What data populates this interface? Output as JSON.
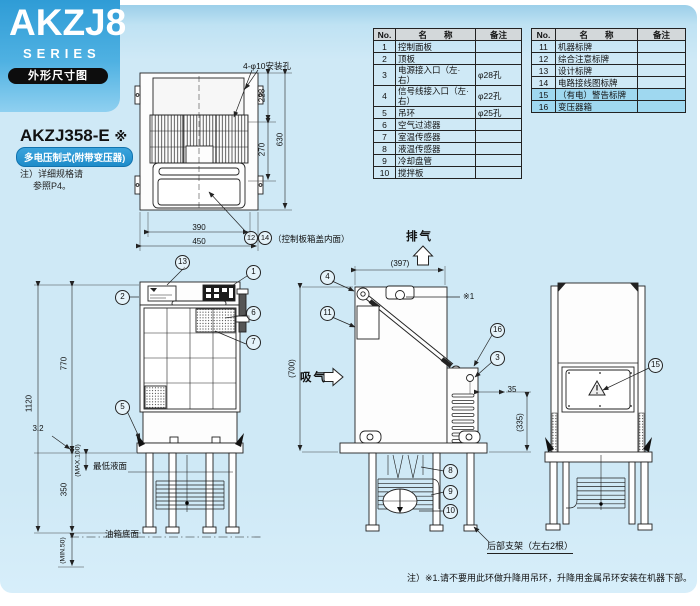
{
  "brand": {
    "series": "AKZJ8",
    "series_label": "SERIES",
    "page_tag": "外形尺寸图"
  },
  "model": {
    "name": "AKZJ358-E",
    "mark": "※",
    "badge": "多电压制式(附带变压器)",
    "note1": "注）详细规格请",
    "note2": "参照P4。"
  },
  "tables": {
    "headers": {
      "no": "No.",
      "name": "名　　称",
      "remark": "备注"
    },
    "left_rows": [
      {
        "no": "1",
        "name": "控制面板",
        "remark": ""
      },
      {
        "no": "2",
        "name": "顶板",
        "remark": ""
      },
      {
        "no": "3",
        "name": "电源接入口（左·右）",
        "remark": "φ28孔"
      },
      {
        "no": "4",
        "name": "信号线接入口（左·右）",
        "remark": "φ22孔"
      },
      {
        "no": "5",
        "name": "吊环",
        "remark": "φ25孔"
      },
      {
        "no": "6",
        "name": "空气过滤器",
        "remark": ""
      },
      {
        "no": "7",
        "name": "室温传感器",
        "remark": ""
      },
      {
        "no": "8",
        "name": "液温传感器",
        "remark": ""
      },
      {
        "no": "9",
        "name": "冷却盘管",
        "remark": ""
      },
      {
        "no": "10",
        "name": "搅拌板",
        "remark": ""
      }
    ],
    "right_rows": [
      {
        "no": "11",
        "name": "机器标牌",
        "remark": ""
      },
      {
        "no": "12",
        "name": "综合注意标牌",
        "remark": ""
      },
      {
        "no": "13",
        "name": "设计标牌",
        "remark": ""
      },
      {
        "no": "14",
        "name": "电路接线图标牌",
        "remark": ""
      },
      {
        "no": "15",
        "name": "（有电）警告标牌",
        "remark": "",
        "highlight": true
      },
      {
        "no": "16",
        "name": "变压器箱",
        "remark": "",
        "highlight": true
      }
    ]
  },
  "callouts": {
    "c1": "1",
    "c2": "2",
    "c3": "3",
    "c4": "4",
    "c5": "5",
    "c6": "6",
    "c7": "7",
    "c8": "8",
    "c9": "9",
    "c10": "10",
    "c11": "11",
    "c12": "12",
    "c13": "13",
    "c14": "14",
    "c15": "15",
    "c16": "16"
  },
  "top_view": {
    "mount_holes_label": "4-φ10安装孔",
    "cover_note": "（控制板箱盖内面）",
    "dims": {
      "d228": "228",
      "d270": "270",
      "d630": "630",
      "d390": "390",
      "d450": "450"
    }
  },
  "front_view": {
    "dims": {
      "d1120": "1120",
      "d770": "770",
      "d350": "350",
      "d3_2": "3.2",
      "dmax": "(MAX.100)",
      "dmin": "(MIN.50)"
    },
    "labels": {
      "min_liquid_level": "最低液面",
      "tank_bottom": "油箱底面"
    }
  },
  "side_view": {
    "labels": {
      "exhaust": "排气",
      "intake": "吸气",
      "ref_mark": "※1",
      "rear_support": "后部支架（左右2根）"
    },
    "dims": {
      "d397": "(397)",
      "d700": "(700)",
      "d35": "35",
      "d335": "(335)"
    }
  },
  "footnote": "注）※1.请不要用此环做升降用吊环，升降用金属吊环安装在机器下部。"
}
